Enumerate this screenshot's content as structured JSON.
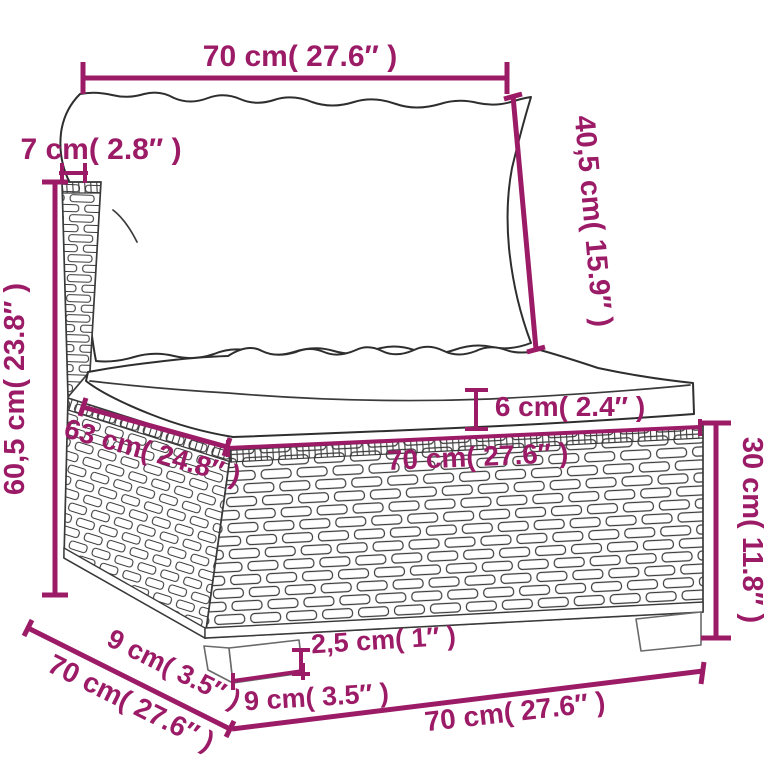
{
  "diagram": {
    "product": "rattan-garden-sofa-middle-section-with-cushions",
    "colors": {
      "dimension": "#9C1B67",
      "line": "#3a3a3a",
      "background": "#ffffff"
    },
    "dimensions": {
      "back_width": {
        "label": "70 cm( 27.6″ )"
      },
      "back_thickness": {
        "label": "7 cm( 2.8″ )"
      },
      "back_cushion": {
        "label": "40,5 cm( 15.9″ )"
      },
      "total_height": {
        "label": "60,5 cm( 23.8″ )"
      },
      "cushion_thickness": {
        "label": "6 cm( 2.4″ )"
      },
      "seat_depth": {
        "label": "63 cm( 24.8″ )"
      },
      "seat_width": {
        "label": "70 cm( 27.6″ )"
      },
      "base_height": {
        "label": "30 cm( 11.8″ )"
      },
      "leg_height": {
        "label": "2,5 cm( 1″ )"
      },
      "leg_depth": {
        "label": "9 cm( 3.5″ )"
      },
      "leg_width": {
        "label": "9 cm( 3.5″ )"
      },
      "total_depth": {
        "label": "70 cm( 27.6″ )"
      },
      "total_width": {
        "label": "70 cm( 27.6″ )"
      }
    }
  }
}
